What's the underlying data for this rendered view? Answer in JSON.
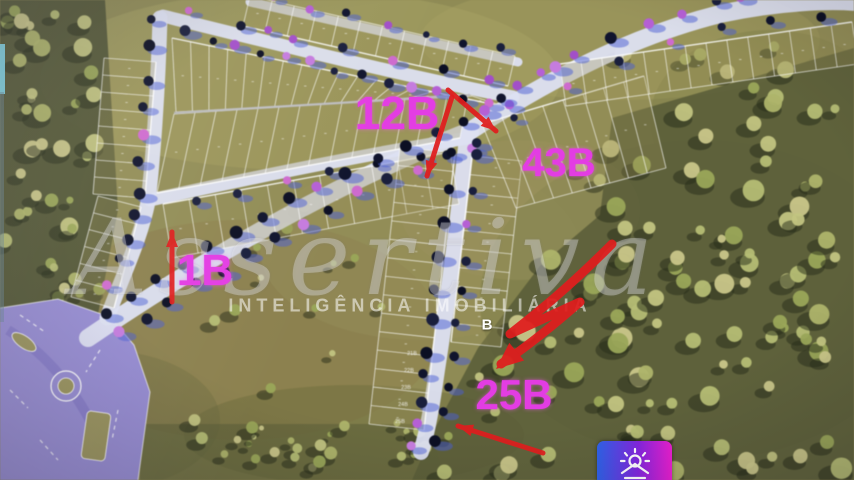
{
  "watermark": {
    "brand": "Assertiva",
    "tagline": "INTELIGÊNCIA IMOBILIÁRIA"
  },
  "annotations": {
    "callout_color": "#e33de3",
    "arrow_color": "#e01d1d",
    "callouts": [
      {
        "id": "callout-12b",
        "label": "12B",
        "x": 397,
        "y": 113,
        "font": 46
      },
      {
        "id": "callout-43b",
        "label": "43B",
        "x": 559,
        "y": 163,
        "font": 40
      },
      {
        "id": "callout-1b",
        "label": "1B",
        "x": 205,
        "y": 271,
        "font": 44
      },
      {
        "id": "callout-25b",
        "label": "25B",
        "x": 514,
        "y": 395,
        "font": 42
      }
    ],
    "block_marker": {
      "label": "B",
      "x": 487,
      "y": 325,
      "font": 15
    },
    "arrows": [
      {
        "name": "arrow-to-43b-lot",
        "d": "M448,90 L496,131",
        "w": 5,
        "head": {
          "x": 496,
          "y": 131,
          "a": 40.5,
          "l": 15,
          "s": 12
        }
      },
      {
        "name": "arrow-to-12b-lot",
        "d": "M452,97 L427,176",
        "w": 5,
        "head": {
          "x": 427,
          "y": 176,
          "a": 107.6,
          "l": 15,
          "s": 12
        }
      },
      {
        "name": "arrow-1b",
        "d": "M172,302 L172,232",
        "w": 5,
        "head": {
          "x": 172,
          "y": 232,
          "a": -90,
          "l": 15,
          "s": 12
        }
      },
      {
        "name": "arrow-scribble-25b",
        "d": "M612,244 C566,290 538,312 510,334 L580,302 C548,330 522,350 501,364",
        "w": 9,
        "head": {
          "x": 496,
          "y": 369,
          "a": 140,
          "l": 27,
          "s": 23
        }
      },
      {
        "name": "arrow-bottom-25b",
        "d": "M543,453 L458,426",
        "w": 5,
        "head": {
          "x": 458,
          "y": 426,
          "a": 197,
          "l": 15,
          "s": 12
        }
      }
    ]
  },
  "lot_numbers_visible": [
    "21B",
    "22B",
    "23B",
    "24B",
    "25B"
  ],
  "logo": {
    "icon": "sunrise-house-icon"
  },
  "map_colors": {
    "grass": "#8f8b53",
    "forest": "#50532f",
    "road": "#dde0f2",
    "paved_interchange": "#968cd4",
    "lot_line": "#ffffff",
    "road_tree_shadow": "#4a5ed8"
  }
}
